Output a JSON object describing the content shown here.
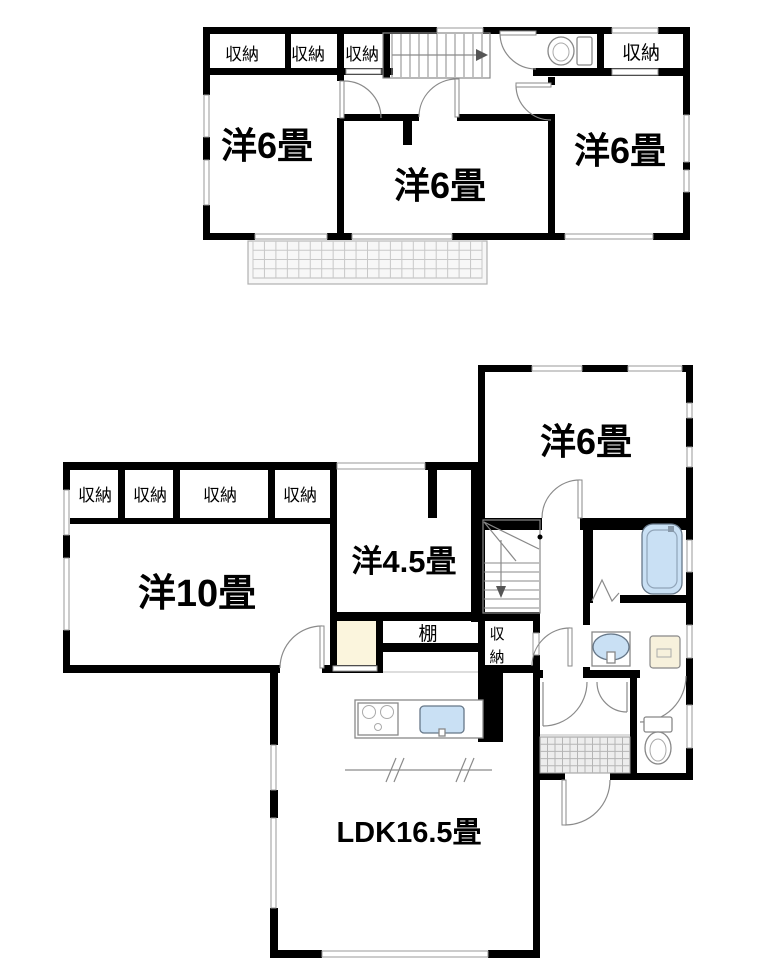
{
  "floor2": {
    "closet1": "収納",
    "closet2": "収納",
    "closet3": "収納",
    "closet4": "収納",
    "room_left": "洋6畳",
    "room_center": "洋6畳",
    "room_right": "洋6畳"
  },
  "floor1": {
    "closet1": "収納",
    "closet2": "収納",
    "closet3": "収納",
    "closet4": "収納",
    "room_west": "洋10畳",
    "room_mid": "洋4.5畳",
    "room_east": "洋6畳",
    "shelf": "棚",
    "stair_closet_char1": "収",
    "stair_closet_char2": "納",
    "ldk": "LDK16.5畳"
  },
  "colors": {
    "wall": "#000000",
    "line": "#888888",
    "water_fixture": "#c9e0f4",
    "closet_fill": "#fbf5dd",
    "tile": "#ededed",
    "balcony": "#f7f7f7"
  }
}
